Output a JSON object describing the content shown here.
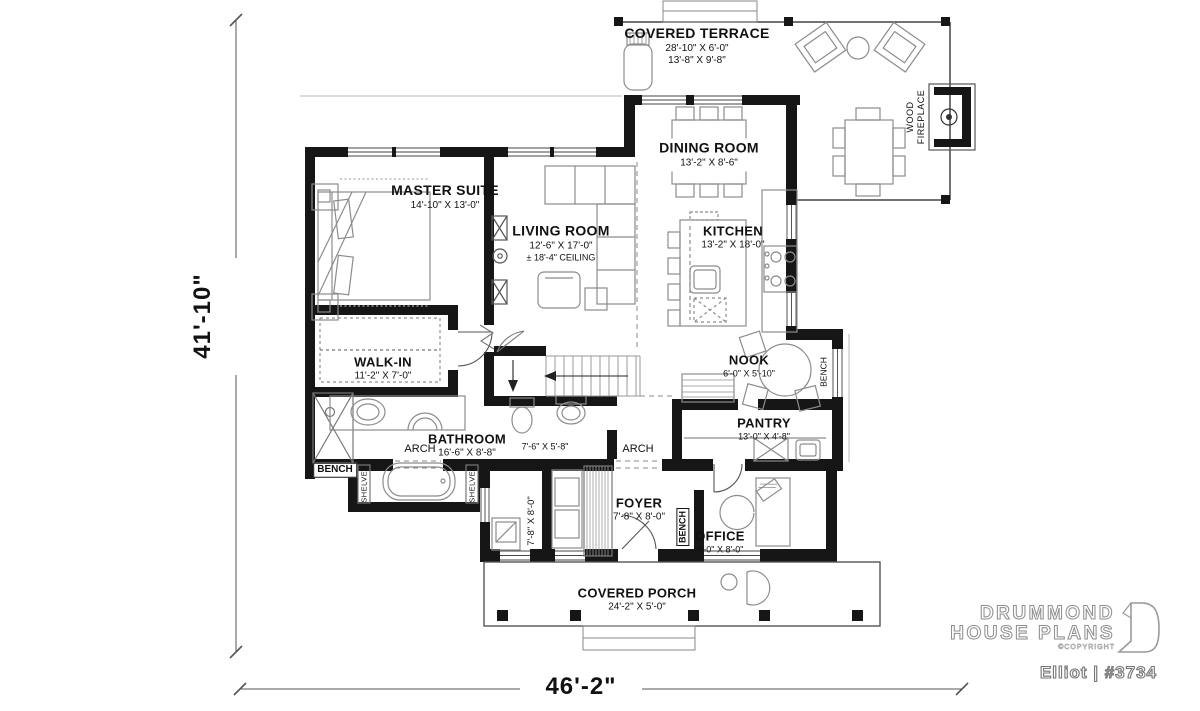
{
  "colors": {
    "wall": "#161616",
    "thin_line": "#444444",
    "furniture_line": "#8c8c8c",
    "text": "#111111",
    "brand_fill": "#ffffff",
    "brand_outline": "#8f8f8f"
  },
  "overall_dimensions": {
    "depth": "41'-10\"",
    "width": "46'-2\""
  },
  "rooms": {
    "covered_terrace": {
      "name": "COVERED TERRACE",
      "dims1": "28'-10\" X 6'-0\"",
      "dims2": "13'-8\" X 9'-8\""
    },
    "dining_room": {
      "name": "DINING ROOM",
      "dims": "13'-2\" X 8'-6\""
    },
    "master_suite": {
      "name": "MASTER SUITE",
      "dims": "14'-10\" X 13'-0\""
    },
    "living_room": {
      "name": "LIVING ROOM",
      "dims": "12'-6\" X 17'-0\"",
      "ceiling": "± 18'-4\" CEILING"
    },
    "kitchen": {
      "name": "KITCHEN",
      "dims": "13'-2\" X 18'-0\""
    },
    "walk_in": {
      "name": "WALK-IN",
      "dims": "11'-2\" X 7'-0\""
    },
    "nook": {
      "name": "NOOK",
      "dims": "6'-0\" X 5'-10\""
    },
    "bathroom": {
      "name": "BATHROOM",
      "dims": "16'-6\" X 8'-8\""
    },
    "pantry": {
      "name": "PANTRY",
      "dims": "13'-0\" X 4'-8\""
    },
    "foyer": {
      "name": "FOYER",
      "dims": "7'-8\" X 8'-0\""
    },
    "office": {
      "name": "OFFICE",
      "dims": "8'-0\" X 8'-0\""
    },
    "covered_porch": {
      "name": "COVERED PORCH",
      "dims": "24'-2\" X 5'-0\""
    }
  },
  "annotations": {
    "wood_fireplace_line1": "WOOD",
    "wood_fireplace_line2": "FIREPLACE",
    "arch": "ARCH",
    "bench": "BENCH",
    "shelves": "SHELVES",
    "wc_dims": "7'-6\" X 5'-8\"",
    "mudroom_dims": "7'-8\" X 8'-0\""
  },
  "branding": {
    "name_line1": "DRUMMOND",
    "name_line2": "HOUSE PLANS",
    "copyright": "©COPYRIGHT",
    "plan_name": "Elliot | #3734"
  }
}
